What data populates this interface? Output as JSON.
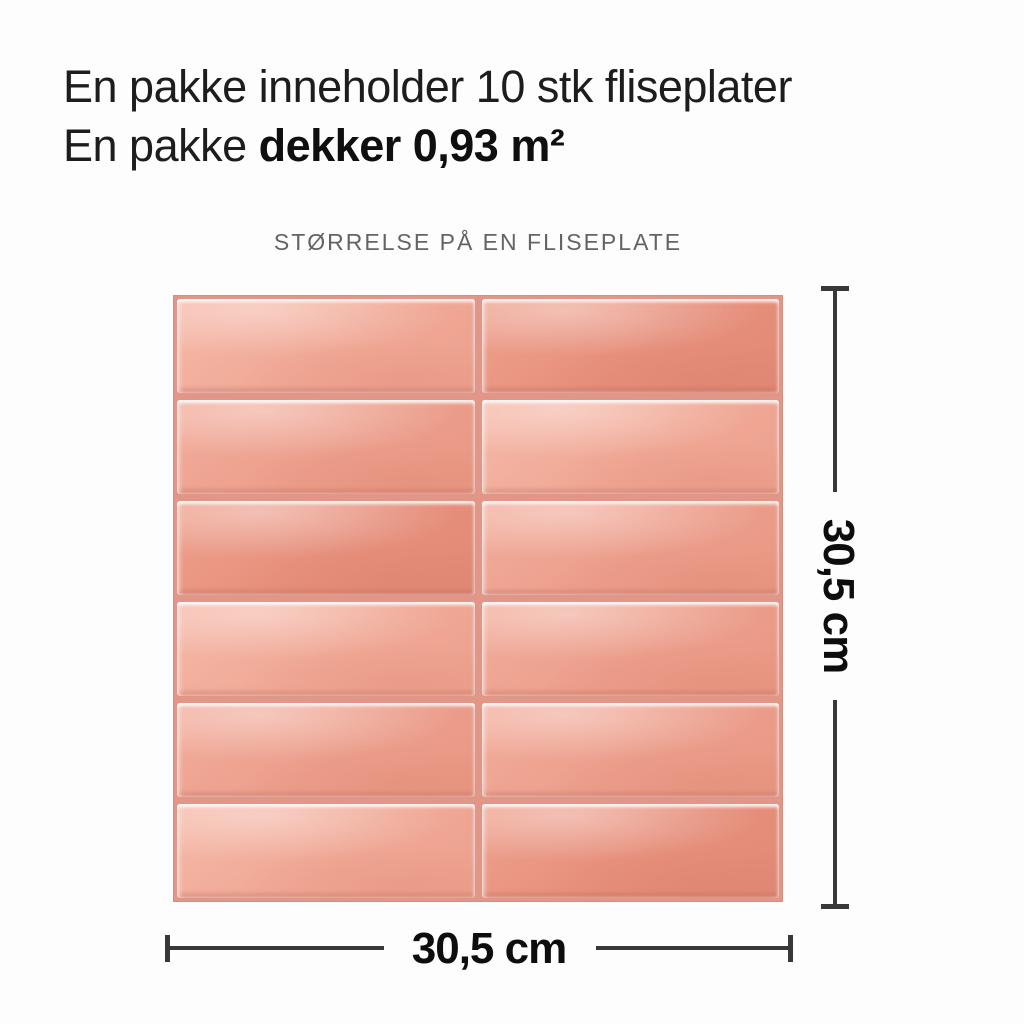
{
  "header": {
    "line1": "En pakke inneholder 10 stk fliseplater",
    "line2_regular": "En pakke ",
    "line2_bold": "dekker 0,93 m²"
  },
  "diagram": {
    "caption": "STØRRELSE PÅ EN FLISEPLATE",
    "dimensions": {
      "width_label": "30,5 cm",
      "height_label": "30,5 cm"
    },
    "tile_panel": {
      "rows": 6,
      "columns": 2,
      "tiles": [
        {
          "tone": "light"
        },
        {
          "tone": "dark"
        },
        {
          "tone": "mid"
        },
        {
          "tone": "light"
        },
        {
          "tone": "dark"
        },
        {
          "tone": "mid"
        },
        {
          "tone": "light"
        },
        {
          "tone": "mid"
        },
        {
          "tone": "mid"
        },
        {
          "tone": "mid"
        },
        {
          "tone": "light"
        },
        {
          "tone": "dark"
        }
      ]
    },
    "colors": {
      "tile_base": "#eda08e",
      "tile_light": "#f6b9a9",
      "tile_dark": "#e58f7c",
      "grout": "#e19687",
      "dimension_line": "#383838",
      "heading_text": "#1d1d1d",
      "caption_text": "#646464"
    }
  }
}
